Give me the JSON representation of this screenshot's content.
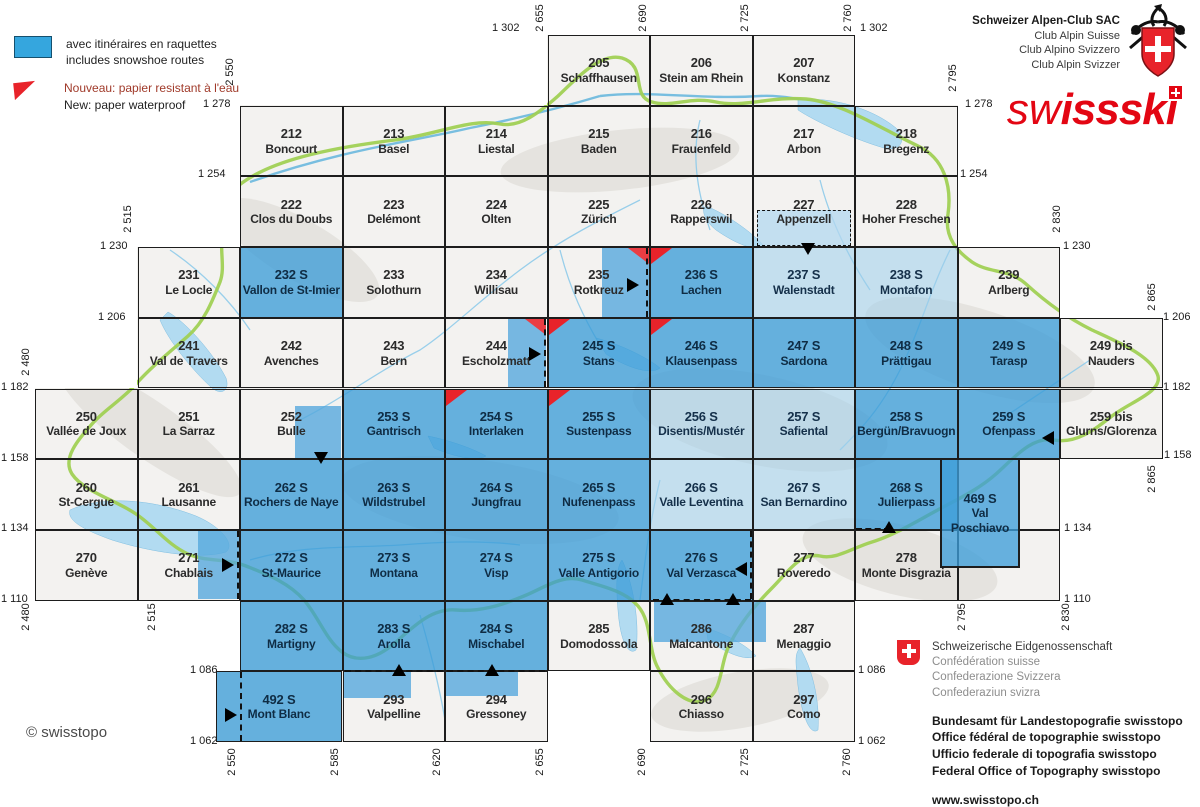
{
  "legend": {
    "snowshoe_fr": "avec itinéraires en raquettes",
    "snowshoe_en": "includes snowshoe routes",
    "waterproof_fr": "Nouveau: papier resistant à l'eau",
    "waterproof_en": "New: paper waterproof"
  },
  "sac_block": {
    "line1": "Schweizer Alpen-Club SAC",
    "line2": "Club Alpin Suisse",
    "line3": "Club Alpino Svizzero",
    "line4": "Club Alpin Svizzer"
  },
  "swissski_logo": {
    "part1": "sw",
    "part2": "issski"
  },
  "copyright": "© swisstopo",
  "confederation_block": {
    "l1": "Schweizerische Eidgenossenschaft",
    "l2": "Confédération suisse",
    "l3": "Confederazione Svizzera",
    "l4": "Confederaziun svizra",
    "b1": "Bundesamt für Landestopografie swisstopo",
    "b2": "Office fédéral de topographie swisstopo",
    "b3": "Ufficio federale di topografia swisstopo",
    "b4": "Federal Office of Topography swisstopo",
    "url": "www.swisstopo.ch"
  },
  "colors": {
    "sheet_blue": "#4fa8de",
    "sheet_light_blue": "#bcdcf0",
    "marker_red": "#e8232a",
    "logo_red": "#e30613",
    "border_green": "#94c93d"
  },
  "grid": {
    "x0": 35,
    "y0": 35,
    "col_width": 102.5,
    "row_height": 70.7
  },
  "sheets": [
    {
      "num": "205",
      "name": "Schaffhausen",
      "col": 5,
      "row": 0,
      "f": "w"
    },
    {
      "num": "206",
      "name": "Stein am Rhein",
      "col": 6,
      "row": 0,
      "f": "w"
    },
    {
      "num": "207",
      "name": "Konstanz",
      "col": 7,
      "row": 0,
      "f": "w"
    },
    {
      "num": "212",
      "name": "Boncourt",
      "col": 2,
      "row": 1,
      "f": "w"
    },
    {
      "num": "213",
      "name": "Basel",
      "col": 3,
      "row": 1,
      "f": "w"
    },
    {
      "num": "214",
      "name": "Liestal",
      "col": 4,
      "row": 1,
      "f": "w"
    },
    {
      "num": "215",
      "name": "Baden",
      "col": 5,
      "row": 1,
      "f": "w"
    },
    {
      "num": "216",
      "name": "Frauenfeld",
      "col": 6,
      "row": 1,
      "f": "w"
    },
    {
      "num": "217",
      "name": "Arbon",
      "col": 7,
      "row": 1,
      "f": "w"
    },
    {
      "num": "218",
      "name": "Bregenz",
      "col": 8,
      "row": 1,
      "f": "w"
    },
    {
      "num": "222",
      "name": "Clos du Doubs",
      "col": 2,
      "row": 2,
      "f": "w"
    },
    {
      "num": "223",
      "name": "Delémont",
      "col": 3,
      "row": 2,
      "f": "w"
    },
    {
      "num": "224",
      "name": "Olten",
      "col": 4,
      "row": 2,
      "f": "w"
    },
    {
      "num": "225",
      "name": "Zürich",
      "col": 5,
      "row": 2,
      "f": "w"
    },
    {
      "num": "226",
      "name": "Rapperswil",
      "col": 6,
      "row": 2,
      "f": "w"
    },
    {
      "num": "227",
      "name": "Appenzell",
      "col": 7,
      "row": 2,
      "f": "w"
    },
    {
      "num": "228",
      "name": "Hoher Freschen",
      "col": 8,
      "row": 2,
      "f": "w"
    },
    {
      "num": "231",
      "name": "Le Locle",
      "col": 1,
      "row": 3,
      "f": "w"
    },
    {
      "num": "232 S",
      "name": "Vallon de St-Imier",
      "col": 2,
      "row": 3,
      "f": "b"
    },
    {
      "num": "233",
      "name": "Solothurn",
      "col": 3,
      "row": 3,
      "f": "w"
    },
    {
      "num": "234",
      "name": "Willisau",
      "col": 4,
      "row": 3,
      "f": "w"
    },
    {
      "num": "235",
      "name": "Rotkreuz",
      "col": 5,
      "row": 3,
      "f": "w"
    },
    {
      "num": "236 S",
      "name": "Lachen",
      "col": 6,
      "row": 3,
      "f": "b",
      "red": "tl"
    },
    {
      "num": "237 S",
      "name": "Walenstadt",
      "col": 7,
      "row": 3,
      "f": "l"
    },
    {
      "num": "238 S",
      "name": "Montafon",
      "col": 8,
      "row": 3,
      "f": "l"
    },
    {
      "num": "239",
      "name": "Arlberg",
      "col": 9,
      "row": 3,
      "f": "w"
    },
    {
      "num": "241",
      "name": "Val de Travers",
      "col": 1,
      "row": 4,
      "f": "w"
    },
    {
      "num": "242",
      "name": "Avenches",
      "col": 2,
      "row": 4,
      "f": "w"
    },
    {
      "num": "243",
      "name": "Bern",
      "col": 3,
      "row": 4,
      "f": "w"
    },
    {
      "num": "244",
      "name": "Escholzmatt",
      "col": 4,
      "row": 4,
      "f": "w"
    },
    {
      "num": "245 S",
      "name": "Stans",
      "col": 5,
      "row": 4,
      "f": "b",
      "red": "tl"
    },
    {
      "num": "246 S",
      "name": "Klausenpass",
      "col": 6,
      "row": 4,
      "f": "b",
      "red": "tl"
    },
    {
      "num": "247 S",
      "name": "Sardona",
      "col": 7,
      "row": 4,
      "f": "b"
    },
    {
      "num": "248 S",
      "name": "Prättigau",
      "col": 8,
      "row": 4,
      "f": "b"
    },
    {
      "num": "249 S",
      "name": "Tarasp",
      "col": 9,
      "row": 4,
      "f": "b"
    },
    {
      "num": "249 bis",
      "name": "Nauders",
      "col": 10,
      "row": 4,
      "f": "w"
    },
    {
      "num": "250",
      "name": "Vallée de Joux",
      "col": 0,
      "row": 5,
      "f": "w"
    },
    {
      "num": "251",
      "name": "La Sarraz",
      "col": 1,
      "row": 5,
      "f": "w"
    },
    {
      "num": "252",
      "name": "Bulle",
      "col": 2,
      "row": 5,
      "f": "w"
    },
    {
      "num": "253 S",
      "name": "Gantrisch",
      "col": 3,
      "row": 5,
      "f": "b"
    },
    {
      "num": "254 S",
      "name": "Interlaken",
      "col": 4,
      "row": 5,
      "f": "b",
      "red": "tl"
    },
    {
      "num": "255 S",
      "name": "Sustenpass",
      "col": 5,
      "row": 5,
      "f": "b",
      "red": "tl"
    },
    {
      "num": "256 S",
      "name": "Disentis/Mustér",
      "col": 6,
      "row": 5,
      "f": "l"
    },
    {
      "num": "257 S",
      "name": "Safiental",
      "col": 7,
      "row": 5,
      "f": "l"
    },
    {
      "num": "258 S",
      "name": "Bergün/Bravuogn",
      "col": 8,
      "row": 5,
      "f": "b"
    },
    {
      "num": "259 S",
      "name": "Ofenpass",
      "col": 9,
      "row": 5,
      "f": "b"
    },
    {
      "num": "259 bis",
      "name": "Glurns/Glorenza",
      "col": 10,
      "row": 5,
      "f": "w"
    },
    {
      "num": "260",
      "name": "St-Cergue",
      "col": 0,
      "row": 6,
      "f": "w"
    },
    {
      "num": "261",
      "name": "Lausanne",
      "col": 1,
      "row": 6,
      "f": "w"
    },
    {
      "num": "262 S",
      "name": "Rochers de Naye",
      "col": 2,
      "row": 6,
      "f": "b"
    },
    {
      "num": "263 S",
      "name": "Wildstrubel",
      "col": 3,
      "row": 6,
      "f": "b"
    },
    {
      "num": "264 S",
      "name": "Jungfrau",
      "col": 4,
      "row": 6,
      "f": "b"
    },
    {
      "num": "265 S",
      "name": "Nufenenpass",
      "col": 5,
      "row": 6,
      "f": "b"
    },
    {
      "num": "266 S",
      "name": "Valle Leventina",
      "col": 6,
      "row": 6,
      "f": "l"
    },
    {
      "num": "267 S",
      "name": "San Bernardino",
      "col": 7,
      "row": 6,
      "f": "l"
    },
    {
      "num": "268 S",
      "name": "Julierpass",
      "col": 8,
      "row": 6,
      "f": "b"
    },
    {
      "num": "",
      "name": "",
      "col": 9,
      "row": 6,
      "f": "w"
    },
    {
      "num": "270",
      "name": "Genève",
      "col": 0,
      "row": 7,
      "f": "w"
    },
    {
      "num": "271",
      "name": "Chablais",
      "col": 1,
      "row": 7,
      "f": "w"
    },
    {
      "num": "272 S",
      "name": "St-Maurice",
      "col": 2,
      "row": 7,
      "f": "b"
    },
    {
      "num": "273 S",
      "name": "Montana",
      "col": 3,
      "row": 7,
      "f": "b"
    },
    {
      "num": "274 S",
      "name": "Visp",
      "col": 4,
      "row": 7,
      "f": "b"
    },
    {
      "num": "275 S",
      "name": "Valle Antigorio",
      "col": 5,
      "row": 7,
      "f": "b"
    },
    {
      "num": "276 S",
      "name": "Val Verzasca",
      "col": 6,
      "row": 7,
      "f": "b"
    },
    {
      "num": "277",
      "name": "Roveredo",
      "col": 7,
      "row": 7,
      "f": "w"
    },
    {
      "num": "278",
      "name": "Monte Disgrazia",
      "col": 8,
      "row": 7,
      "f": "w"
    },
    {
      "num": "",
      "name": "",
      "col": 9,
      "row": 7,
      "f": "w"
    },
    {
      "num": "282 S",
      "name": "Martigny",
      "col": 2,
      "row": 8,
      "f": "b"
    },
    {
      "num": "283 S",
      "name": "Arolla",
      "col": 3,
      "row": 8,
      "f": "b"
    },
    {
      "num": "284 S",
      "name": "Mischabel",
      "col": 4,
      "row": 8,
      "f": "b"
    },
    {
      "num": "285",
      "name": "Domodossola",
      "col": 5,
      "row": 8,
      "f": "w"
    },
    {
      "num": "286",
      "name": "Malcantone",
      "col": 6,
      "row": 8,
      "f": "w"
    },
    {
      "num": "287",
      "name": "Menaggio",
      "col": 7,
      "row": 8,
      "f": "w"
    },
    {
      "num": "492 S",
      "name": "Mont Blanc",
      "rect": {
        "x": 216,
        "y": 671,
        "w": 126,
        "h": 71
      },
      "f": "b"
    },
    {
      "num": "293",
      "name": "Valpelline",
      "col": 3,
      "row": 9,
      "f": "w"
    },
    {
      "num": "294",
      "name": "Gressoney",
      "col": 4,
      "row": 9,
      "f": "w"
    },
    {
      "num": "296",
      "name": "Chiasso",
      "col": 6,
      "row": 9,
      "f": "w"
    },
    {
      "num": "297",
      "name": "Como",
      "col": 7,
      "row": 9,
      "f": "w"
    },
    {
      "num": "469 S",
      "name": "Val Poschiavo",
      "rect": {
        "x": 940,
        "y": 458,
        "w": 80,
        "h": 110
      },
      "f": "b",
      "special": true
    }
  ],
  "subareas": [
    {
      "x": 757,
      "y": 210,
      "w": 94,
      "h": 36,
      "f": "l"
    },
    {
      "x": 602,
      "y": 248,
      "w": 47,
      "h": 69,
      "f": "b",
      "red": "tr"
    },
    {
      "x": 508,
      "y": 319,
      "w": 38,
      "h": 68,
      "f": "b",
      "red": "tr"
    },
    {
      "x": 295,
      "y": 406,
      "w": 46,
      "h": 52,
      "f": "b"
    },
    {
      "x": 198,
      "y": 531,
      "w": 41,
      "h": 68,
      "f": "b"
    },
    {
      "x": 654,
      "y": 601,
      "w": 112,
      "h": 41,
      "f": "b"
    },
    {
      "x": 343,
      "y": 672,
      "w": 68,
      "h": 26,
      "f": "b"
    },
    {
      "x": 446,
      "y": 672,
      "w": 72,
      "h": 24,
      "f": "b"
    }
  ],
  "dashes": [
    {
      "x": 757,
      "y": 210,
      "w": 94,
      "h": 36,
      "rect": true
    },
    {
      "x": 646,
      "y": 248,
      "len": 69,
      "v": true
    },
    {
      "x": 544,
      "y": 319,
      "len": 68,
      "v": true
    },
    {
      "x": 237,
      "y": 531,
      "len": 68,
      "v": true
    },
    {
      "x": 750,
      "y": 531,
      "len": 68,
      "v": true
    },
    {
      "x": 653,
      "y": 599,
      "len": 98,
      "h": true
    },
    {
      "x": 856,
      "y": 528,
      "len": 34,
      "h": true
    },
    {
      "x": 345,
      "y": 670,
      "len": 200,
      "h": true
    },
    {
      "x": 240,
      "y": 672,
      "len": 69,
      "v": true
    }
  ],
  "markers": [
    {
      "d": "down",
      "x": 808,
      "y": 249
    },
    {
      "d": "right",
      "x": 634,
      "y": 284
    },
    {
      "d": "right",
      "x": 536,
      "y": 353
    },
    {
      "d": "down",
      "x": 321,
      "y": 458
    },
    {
      "d": "left",
      "x": 1049,
      "y": 437
    },
    {
      "d": "up",
      "x": 889,
      "y": 527
    },
    {
      "d": "right",
      "x": 229,
      "y": 564
    },
    {
      "d": "left",
      "x": 742,
      "y": 568
    },
    {
      "d": "up",
      "x": 667,
      "y": 599
    },
    {
      "d": "up",
      "x": 733,
      "y": 599
    },
    {
      "d": "up",
      "x": 399,
      "y": 670
    },
    {
      "d": "up",
      "x": 492,
      "y": 670
    },
    {
      "d": "right",
      "x": 232,
      "y": 714
    }
  ],
  "coordinates": [
    {
      "t": "1 302",
      "x": 492,
      "y": 22
    },
    {
      "t": "1 302",
      "x": 860,
      "y": 22
    },
    {
      "t": "1 278",
      "x": 203,
      "y": 98
    },
    {
      "t": "1 278",
      "x": 965,
      "y": 98
    },
    {
      "t": "1 254",
      "x": 198,
      "y": 168
    },
    {
      "t": "1 254",
      "x": 960,
      "y": 168
    },
    {
      "t": "1 230",
      "x": 100,
      "y": 240
    },
    {
      "t": "1 230",
      "x": 1063,
      "y": 240
    },
    {
      "t": "1 206",
      "x": 98,
      "y": 311
    },
    {
      "t": "1 206",
      "x": 1163,
      "y": 311
    },
    {
      "t": "1 182",
      "x": 1,
      "y": 381
    },
    {
      "t": "1 182",
      "x": 1163,
      "y": 381
    },
    {
      "t": "1 158",
      "x": 1,
      "y": 452
    },
    {
      "t": "1 158",
      "x": 1164,
      "y": 449
    },
    {
      "t": "1 134",
      "x": 1,
      "y": 522
    },
    {
      "t": "1 134",
      "x": 1064,
      "y": 522
    },
    {
      "t": "1 110",
      "x": 1,
      "y": 593
    },
    {
      "t": "1 110",
      "x": 1064,
      "y": 593
    },
    {
      "t": "1 086",
      "x": 190,
      "y": 664
    },
    {
      "t": "1 086",
      "x": 858,
      "y": 664
    },
    {
      "t": "1 062",
      "x": 190,
      "y": 735
    },
    {
      "t": "1 062",
      "x": 858,
      "y": 735
    },
    {
      "t": "2 550",
      "x": 230,
      "y": 72,
      "v": true
    },
    {
      "t": "2 515",
      "x": 128,
      "y": 219,
      "v": true
    },
    {
      "t": "2 480",
      "x": 26,
      "y": 362,
      "v": true
    },
    {
      "t": "2 655",
      "x": 540,
      "y": 18,
      "v": true
    },
    {
      "t": "2 690",
      "x": 643,
      "y": 18,
      "v": true
    },
    {
      "t": "2 725",
      "x": 745,
      "y": 18,
      "v": true
    },
    {
      "t": "2 760",
      "x": 848,
      "y": 18,
      "v": true
    },
    {
      "t": "2 795",
      "x": 953,
      "y": 78,
      "v": true
    },
    {
      "t": "2 830",
      "x": 1057,
      "y": 219,
      "v": true
    },
    {
      "t": "2 865",
      "x": 1152,
      "y": 297,
      "v": true
    },
    {
      "t": "2 865",
      "x": 1152,
      "y": 479,
      "v": true
    },
    {
      "t": "2 480",
      "x": 26,
      "y": 617,
      "v": true
    },
    {
      "t": "2 515",
      "x": 152,
      "y": 617,
      "v": true
    },
    {
      "t": "2 550",
      "x": 232,
      "y": 762,
      "v": true
    },
    {
      "t": "2 585",
      "x": 335,
      "y": 762,
      "v": true
    },
    {
      "t": "2 620",
      "x": 437,
      "y": 762,
      "v": true
    },
    {
      "t": "2 655",
      "x": 540,
      "y": 762,
      "v": true
    },
    {
      "t": "2 690",
      "x": 642,
      "y": 762,
      "v": true
    },
    {
      "t": "2 725",
      "x": 745,
      "y": 762,
      "v": true
    },
    {
      "t": "2 760",
      "x": 847,
      "y": 762,
      "v": true
    },
    {
      "t": "2 795",
      "x": 962,
      "y": 617,
      "v": true
    },
    {
      "t": "2 830",
      "x": 1066,
      "y": 617,
      "v": true
    }
  ]
}
